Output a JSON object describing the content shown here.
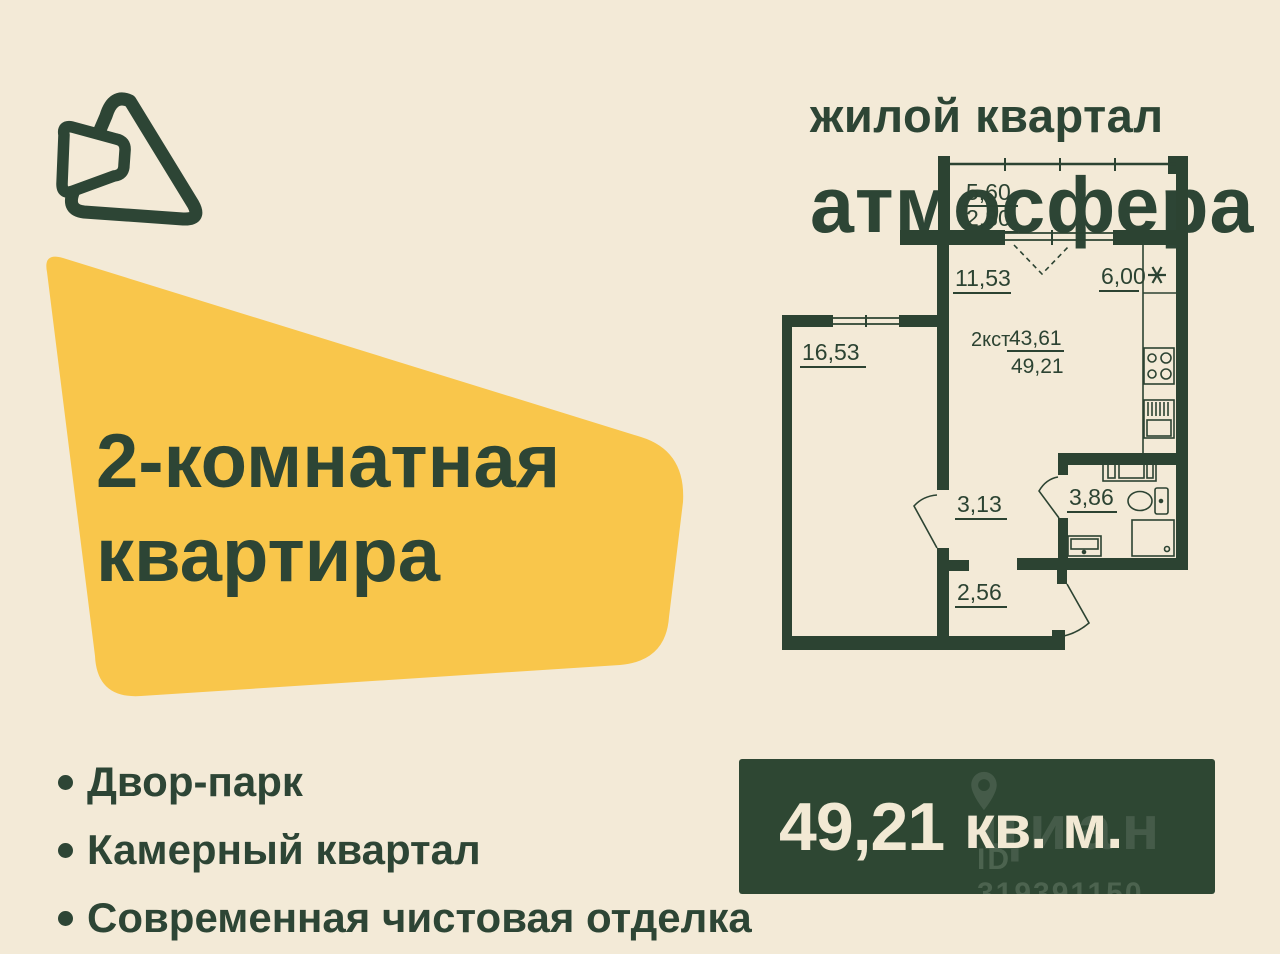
{
  "colors": {
    "background": "#f3ead7",
    "ink_green": "#2d4535",
    "accent_yellow": "#f9c64b",
    "panel_green": "#2e4733",
    "panel_text": "#f2e9d4",
    "plan_wall": "#2c4332"
  },
  "brand": {
    "tagline": "жилой квартал",
    "name": "атмосфера"
  },
  "headline": {
    "line1": "2-комнатная",
    "line2": "квартира"
  },
  "features": [
    {
      "label": "Двор-парк"
    },
    {
      "label": "Камерный квартал"
    },
    {
      "label": "Современная чистовая отделка"
    }
  ],
  "floor_plan": {
    "balcony_area": "5,60",
    "balcony_area_reduced": "2,80",
    "living_area": "11,53",
    "kitchen_area": "6,00",
    "bedroom_area": "16,53",
    "type_code": "2кст",
    "living_total": "43,61",
    "total_area": "49,21",
    "hall_area": "3,13",
    "bathroom_area": "3,86",
    "corridor_area": "2,56"
  },
  "area_panel": {
    "value": "49,21",
    "unit": "кв. м."
  },
  "watermark": {
    "brand": "циан",
    "listing_id": "ID 319391150"
  }
}
